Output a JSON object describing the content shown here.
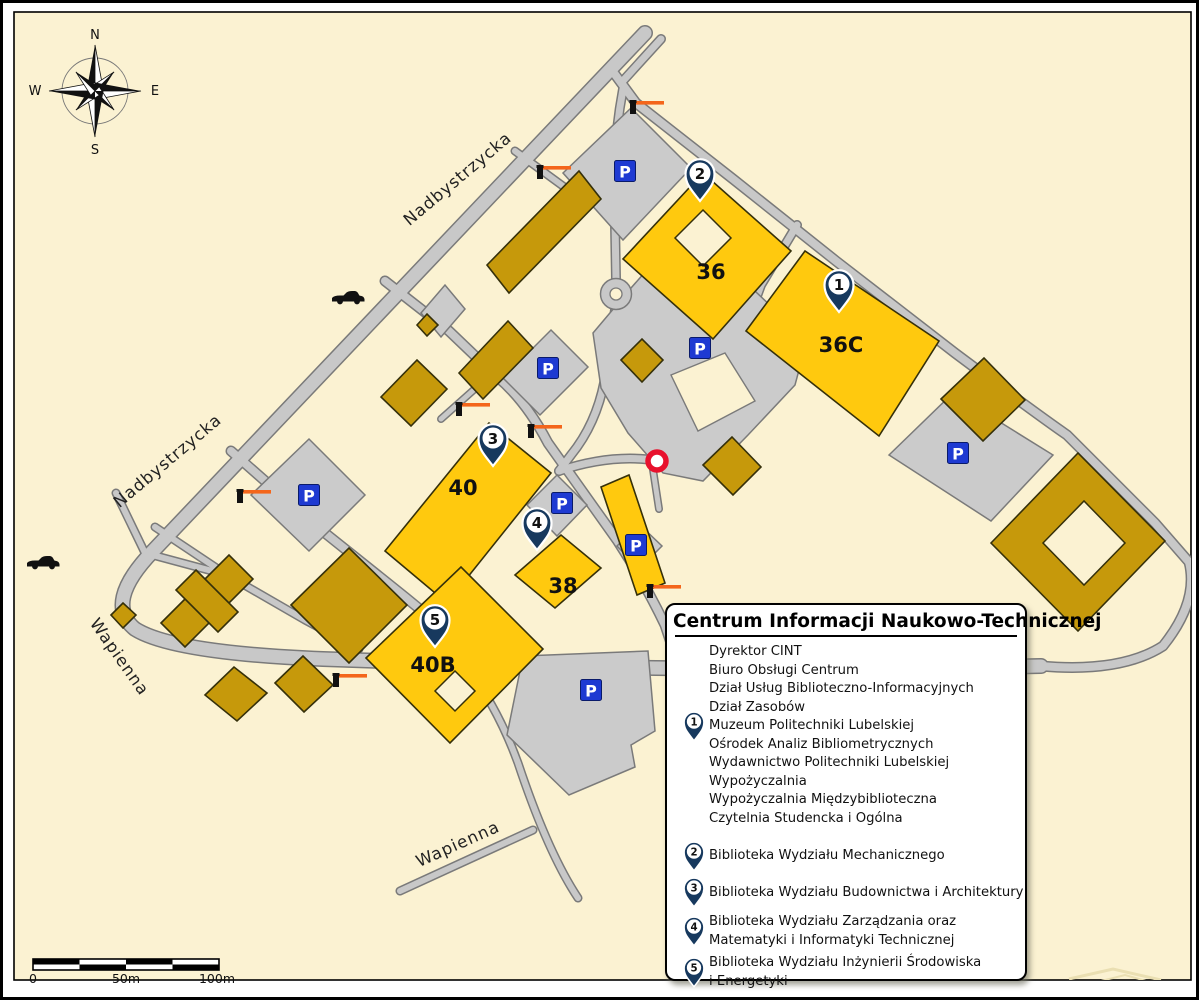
{
  "map": {
    "street_labels": [
      {
        "name": "Nadbystrzycka",
        "x": 458,
        "y": 180,
        "rotation": -40
      },
      {
        "name": "Nadbystrzycka",
        "x": 168,
        "y": 462,
        "rotation": -40
      },
      {
        "name": "Wapienna",
        "x": 112,
        "y": 657,
        "rotation": 55
      },
      {
        "name": "Wapienna",
        "x": 457,
        "y": 846,
        "rotation": -24
      }
    ],
    "building_labels": [
      {
        "text": "36",
        "x": 708,
        "y": 276
      },
      {
        "text": "36C",
        "x": 838,
        "y": 349
      },
      {
        "text": "40",
        "x": 460,
        "y": 492
      },
      {
        "text": "38",
        "x": 560,
        "y": 590
      },
      {
        "text": "40B",
        "x": 430,
        "y": 669
      }
    ],
    "pins": [
      {
        "number": "1",
        "x": 836,
        "y": 283
      },
      {
        "number": "2",
        "x": 697,
        "y": 172
      },
      {
        "number": "3",
        "x": 490,
        "y": 437
      },
      {
        "number": "4",
        "x": 534,
        "y": 521
      },
      {
        "number": "5",
        "x": 432,
        "y": 618
      }
    ],
    "parking_label": "P",
    "parking_signs": [
      [
        622,
        168
      ],
      [
        545,
        365
      ],
      [
        697,
        345
      ],
      [
        306,
        492
      ],
      [
        559,
        500
      ],
      [
        633,
        542
      ],
      [
        955,
        450
      ],
      [
        588,
        687
      ]
    ],
    "barriers": [
      [
        630,
        100
      ],
      [
        537,
        165
      ],
      [
        456,
        402
      ],
      [
        528,
        424
      ],
      [
        237,
        489
      ],
      [
        647,
        584
      ],
      [
        333,
        673
      ]
    ],
    "cars": [
      [
        345,
        295
      ],
      [
        40,
        560
      ]
    ],
    "red_circle": {
      "x": 654,
      "y": 458
    },
    "compass": {
      "n": "N",
      "e": "E",
      "s": "S",
      "w": "W"
    },
    "scale_bar": {
      "labels": [
        "0",
        "50m",
        "100m"
      ]
    }
  },
  "legend": {
    "title": "Centrum Informacji Naukowo-Technicznej",
    "groups": [
      {
        "pin": "1",
        "pin_line": 4,
        "lines": [
          "Dyrektor CINT",
          "Biuro Obsługi Centrum",
          "Dział Usług Biblioteczno-Informacyjnych",
          "Dział Zasobów",
          "Muzeum Politechniki Lubelskiej",
          "Ośrodek Analiz Bibliometrycznych",
          "Wydawnictwo Politechniki Lubelskiej",
          "Wypożyczalnia",
          "Wypożyczalnia Międzybiblioteczna",
          "Czytelnia Studencka i Ogólna"
        ]
      },
      {
        "pin": "2",
        "lines": [
          "Biblioteka Wydziału Mechanicznego"
        ]
      },
      {
        "pin": "3",
        "lines": [
          "Biblioteka Wydziału Budownictwa i Architektury"
        ]
      },
      {
        "pin": "4",
        "lines": [
          "Biblioteka Wydziału Zarządzania oraz",
          "Matematyki i Informatyki Technicznej"
        ]
      },
      {
        "pin": "5",
        "lines": [
          "Biblioteka Wydziału Inżynierii Środowiska",
          "i Energetyki"
        ]
      }
    ]
  },
  "icons": {
    "parking": "parking-icon",
    "pin": "location-pin-icon",
    "barrier": "gate-barrier-icon",
    "car": "car-icon",
    "red_circle": "entrance-ring-icon",
    "compass": "compass-rose-icon"
  },
  "colors": {
    "cream": "#FBF2D2",
    "road": "#C8C8C8",
    "casing": "#7A7A7A",
    "lot": "#CBCBCB",
    "yellow": "#FFC90E",
    "gold": "#C6990B",
    "building_stroke": "#35300A",
    "pin_navy": "#17395E",
    "parking_blue": "#1E3AD2",
    "barrier_orange": "#F4661B",
    "red": "#E8112D"
  }
}
